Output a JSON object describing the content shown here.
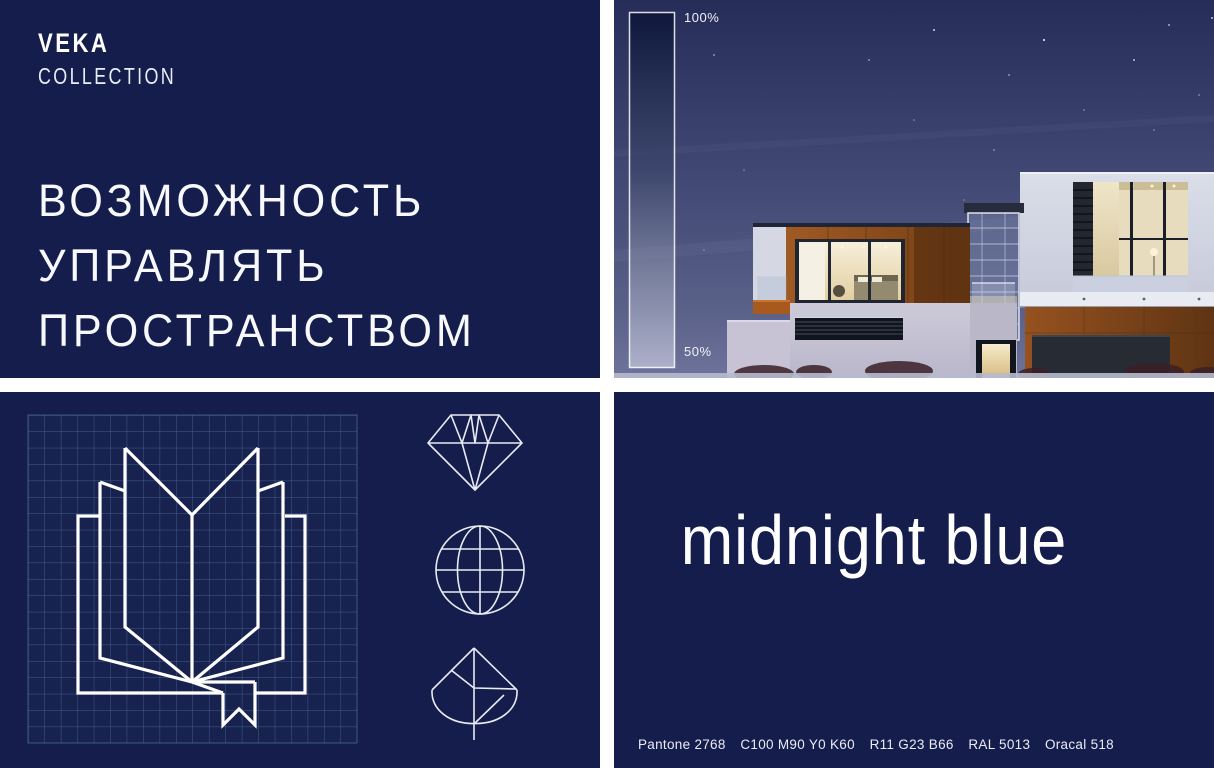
{
  "brand": {
    "logo_main": "VEKA",
    "logo_sub": "COLLECTION"
  },
  "hero": {
    "slogan_lines": [
      "ВОЗМОЖНОСТЬ",
      "УПРАВЛЯТЬ",
      "ПРОСТРАНСТВОМ"
    ]
  },
  "photo_panel": {
    "scale_top": "100%",
    "scale_bottom": "50%"
  },
  "color_panel": {
    "name": "midnight blue",
    "specs": [
      "Pantone 2768",
      "C100 M90 Y0 K60",
      "R11 G23 B66",
      "RAL 5013",
      "Oracal 518"
    ]
  },
  "icons": {
    "blueprint_logo": "open-book-with-ribbon",
    "side_icons": [
      "diamond",
      "globe",
      "leaf"
    ]
  },
  "palette": {
    "brand_navy": "#141D4B",
    "sky_top": "#262D58",
    "sky_bottom": "#6E739B",
    "corten_rust": "#96521F",
    "window_glow": "#F6EDD6",
    "blueprint_grid_blue": "#4F74A6",
    "line_white": "#FFFFFF"
  }
}
